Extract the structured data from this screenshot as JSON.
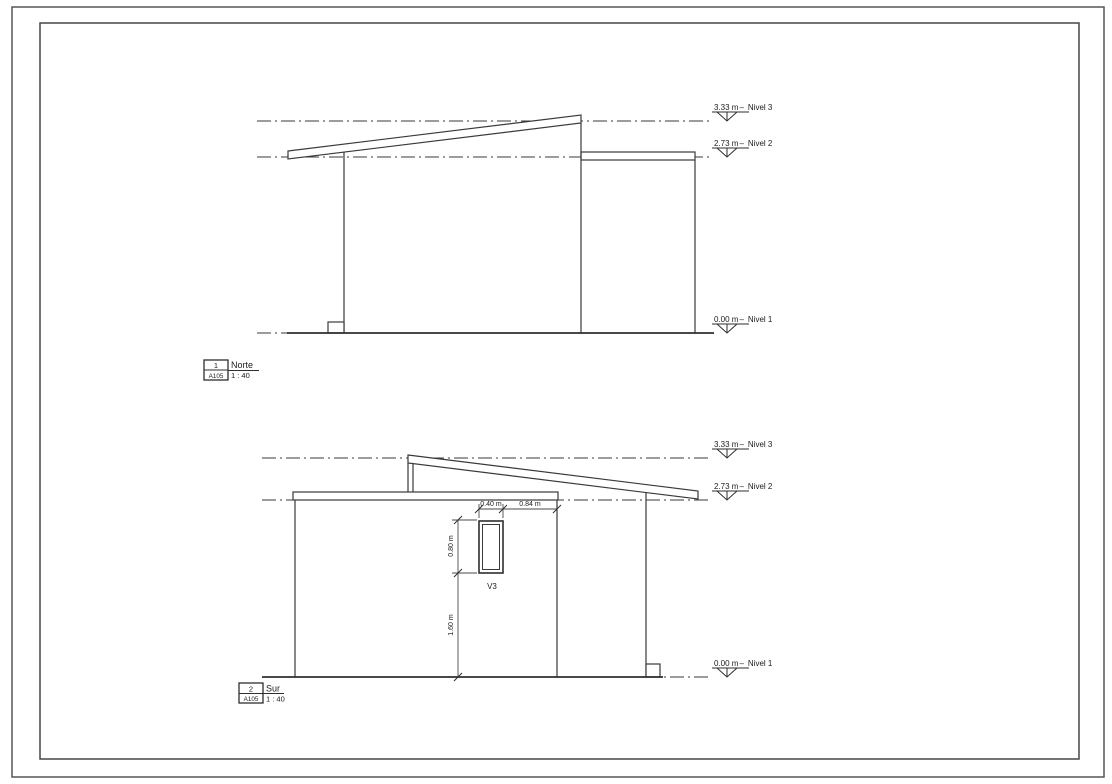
{
  "drawing": {
    "levels_separator": "–",
    "views": [
      {
        "label": "1",
        "sheet": "A105",
        "name": "Norte",
        "scale": "1 : 40",
        "levels": [
          {
            "elevation": "3.33 m",
            "name": "Nivel 3"
          },
          {
            "elevation": "2.73 m",
            "name": "Nivel 2"
          },
          {
            "elevation": "0.00 m",
            "name": "Nivel 1"
          }
        ]
      },
      {
        "label": "2",
        "sheet": "A105",
        "name": "Sur",
        "scale": "1 : 40",
        "levels": [
          {
            "elevation": "3.33 m",
            "name": "Nivel 3"
          },
          {
            "elevation": "2.73 m",
            "name": "Nivel 2"
          },
          {
            "elevation": "0.00 m",
            "name": "Nivel 1"
          }
        ],
        "window": {
          "tag": "V3",
          "width": "0.40 m",
          "offset_right": "0.84 m",
          "height": "0.80 m",
          "sill_height": "1.60 m"
        }
      }
    ]
  }
}
